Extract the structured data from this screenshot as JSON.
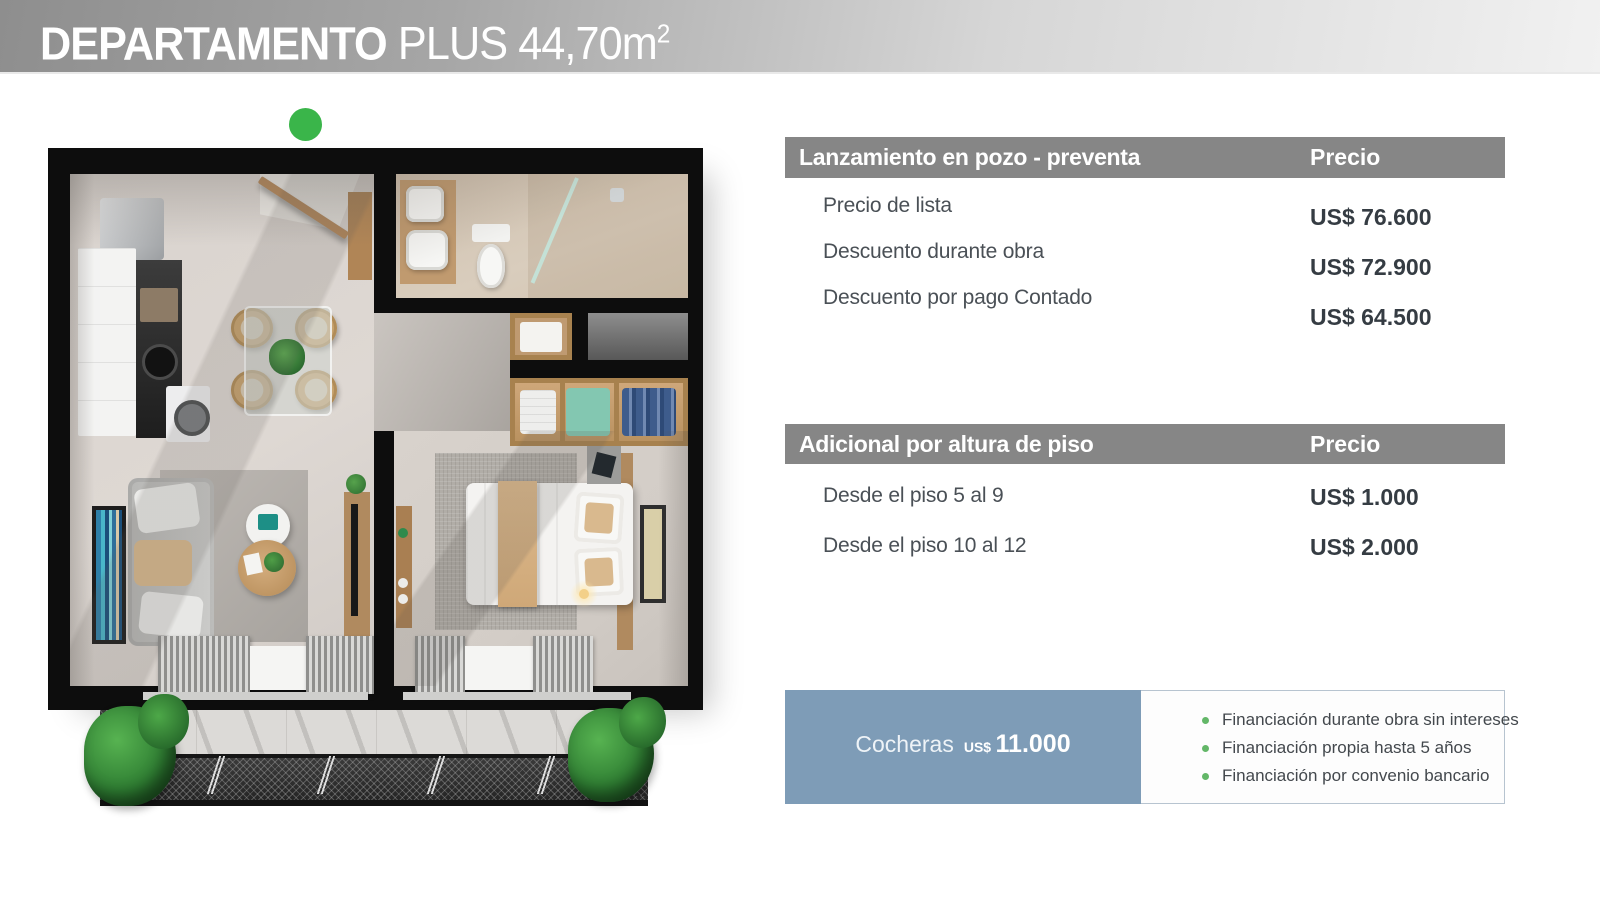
{
  "title": {
    "main": "DEPARTAMENTO",
    "sub": "PLUS 44,70m",
    "sup": "2"
  },
  "tables": [
    {
      "title": "Lanzamiento en pozo - preventa",
      "price_col": "Precio",
      "rows": [
        {
          "label": "Precio de lista",
          "price": "US$ 76.600"
        },
        {
          "label": "Descuento durante obra",
          "price": "US$ 72.900"
        },
        {
          "label": "Descuento por pago Contado",
          "price": "US$ 64.500"
        }
      ]
    },
    {
      "title": "Adicional por altura de piso",
      "price_col": "Precio",
      "rows": [
        {
          "label": "Desde el piso 5 al 9",
          "price": "US$ 1.000"
        },
        {
          "label": "Desde el piso 10 al 12",
          "price": "US$ 2.000"
        }
      ]
    }
  ],
  "cocheras": {
    "label": "Cocheras",
    "currency": "US$",
    "amount": "11.000"
  },
  "financing": [
    "Financiación durante obra sin intereses",
    "Financiación propia hasta 5 años",
    "Financiación por convenio bancario"
  ],
  "colors": {
    "header_bar_gray": "#868686",
    "cocheras_blue": "#7e9cb7",
    "bullet_green": "#63b768",
    "marker_green": "#3ab54a"
  }
}
